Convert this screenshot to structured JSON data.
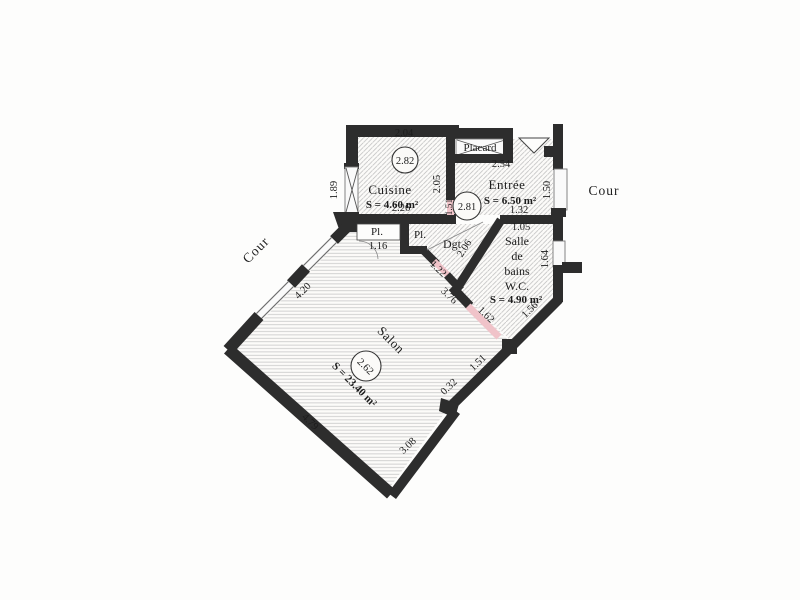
{
  "plan": {
    "rooms": [
      {
        "id": "cuisine",
        "name": "Cuisine",
        "area": "S = 4.60 m²",
        "ceiling_height": "2.82"
      },
      {
        "id": "entree",
        "name": "Entrée",
        "area": "S = 6.50 m²",
        "ceiling_height": "2.81"
      },
      {
        "id": "salle-de-bains-wc",
        "name_lines": [
          "Salle",
          "de",
          "bains",
          "W.C."
        ],
        "area": "S = 4.90 m²"
      },
      {
        "id": "salon",
        "name": "Salon",
        "area": "S = 23.40 m²",
        "ceiling_height": "2.62"
      },
      {
        "id": "degagement",
        "name": "Dgt"
      },
      {
        "id": "placard-entree",
        "name": "Placard"
      },
      {
        "id": "placard-salon",
        "name": "Pl."
      },
      {
        "id": "placard-dgt",
        "name": "Pl."
      }
    ],
    "outside_labels": [
      {
        "side": "left",
        "text": "Cour"
      },
      {
        "side": "right",
        "text": "Cour"
      }
    ],
    "dimensions": [
      "2.04",
      "1.89",
      "2.05",
      "1.51",
      "2.26",
      "2.54",
      "1.32",
      "1.05",
      "1.50",
      "1.64",
      "2.06",
      "1.16",
      "1.22",
      "3.76",
      "1.62",
      "1.56",
      "4.20",
      "4.79",
      "3.08",
      "0.32",
      "1.51"
    ]
  },
  "colors": {
    "wall": "#2d2d2d",
    "hatch": "#c2c2c2",
    "window_fill": "#fafafa",
    "door_opening": "#f2c6cb",
    "text": "#1c1c1c",
    "background": "#fdfdfc"
  }
}
